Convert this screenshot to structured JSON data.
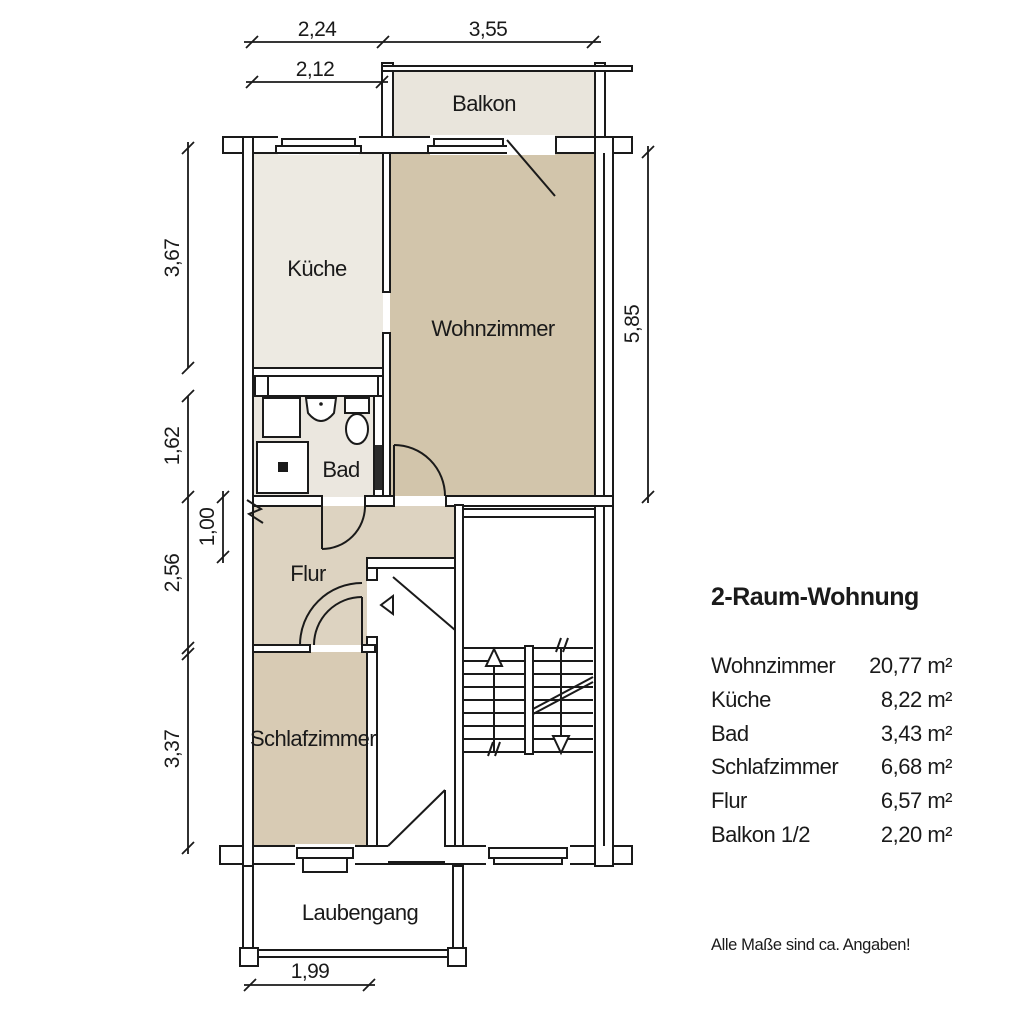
{
  "plan": {
    "rooms": {
      "balkon": {
        "label": "Balkon"
      },
      "kueche": {
        "label": "Küche"
      },
      "wohnzimmer": {
        "label": "Wohnzimmer"
      },
      "bad": {
        "label": "Bad"
      },
      "flur": {
        "label": "Flur"
      },
      "schlafzimmer": {
        "label": "Schlafzimmer"
      },
      "laubengang": {
        "label": "Laubengang"
      }
    },
    "dimensions": {
      "top_left": "2,24",
      "top_right": "3,55",
      "top_inner": "2,12",
      "left_1": "3,67",
      "left_2": "1,62",
      "left_3": "2,56",
      "left_4": "3,37",
      "niche": "1,00",
      "right_side": "5,85",
      "bottom": "1,99"
    },
    "colors": {
      "wohnzimmer": "#d2c5ab",
      "schlafzimmer": "#d8cbb4",
      "flur": "#ddd3c1",
      "kueche": "#edeae2",
      "bad": "#ebe7df",
      "balkon": "#e9e5dc",
      "line": "#1a1a1a",
      "door_slab": "#2b2b2b"
    }
  },
  "legend": {
    "title": "2-Raum-Wohnung",
    "rows": [
      {
        "label": "Wohnzimmer",
        "value": "20,77 m²"
      },
      {
        "label": "Küche",
        "value": "8,22 m²"
      },
      {
        "label": "Bad",
        "value": "3,43 m²"
      },
      {
        "label": "Schlafzimmer",
        "value": "6,68 m²"
      },
      {
        "label": "Flur",
        "value": "6,57 m²"
      },
      {
        "label": "Balkon 1/2",
        "value": "2,20 m²"
      }
    ],
    "note": "Alle Maße sind ca. Angaben!"
  }
}
